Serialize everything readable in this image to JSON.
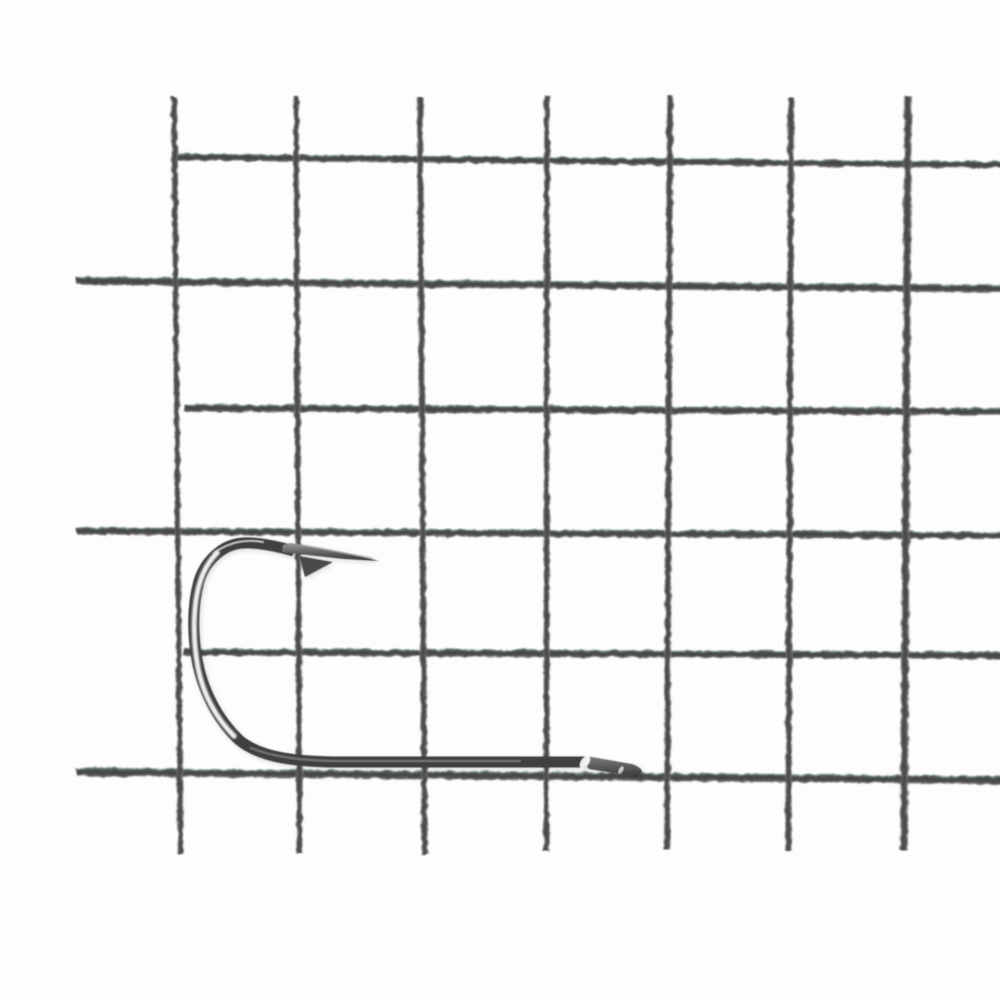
{
  "image": {
    "type": "photograph",
    "width_px": 1000,
    "height_px": 1000,
    "description": "Close-up product photograph of a single polished gunmetal fishing hook with a barbed spear point and a flattened spade end, lying point-up over a dark grey welded wire mesh grid on a white background. No text is visible.",
    "text_content": "none"
  },
  "palette": {
    "background": "#fdfdfd",
    "mesh_wire": "#454545",
    "mesh_fringe_teal": "#7aa29f",
    "hook_wire_dark": "#414141",
    "hook_mid_grey": "#6e6e6e",
    "hook_specular_highlight": "#f5f5f5"
  },
  "mesh": {
    "pattern": "welded square wire mesh",
    "rows_visible": 6,
    "columns_visible": 7,
    "approx_cell_size_px": 122,
    "horizontal_wires": [
      {
        "x": 177,
        "y": 157,
        "len": 828,
        "tilt": 0.55,
        "t": 7.5
      },
      {
        "x": 76,
        "y": 281,
        "len": 929,
        "tilt": 0.48,
        "t": 8.5
      },
      {
        "x": 184,
        "y": 408,
        "len": 821,
        "tilt": 0.26,
        "t": 8
      },
      {
        "x": 76,
        "y": 531,
        "len": 929,
        "tilt": 0.28,
        "t": 8
      },
      {
        "x": 184,
        "y": 652,
        "len": 821,
        "tilt": 0.24,
        "t": 8
      },
      {
        "x": 76,
        "y": 772,
        "len": 929,
        "tilt": 0.5,
        "t": 9
      }
    ],
    "vertical_wires": [
      {
        "x": 174,
        "y": 97,
        "len": 757,
        "tilt": -0.5,
        "t": 6.5
      },
      {
        "x": 296,
        "y": 96,
        "len": 757,
        "tilt": -0.28,
        "t": 6.5
      },
      {
        "x": 420,
        "y": 97,
        "len": 757,
        "tilt": -0.35,
        "t": 7
      },
      {
        "x": 547,
        "y": 96,
        "len": 755,
        "tilt": 0.05,
        "t": 6.5
      },
      {
        "x": 670,
        "y": 96,
        "len": 754,
        "tilt": 0.22,
        "t": 7
      },
      {
        "x": 791,
        "y": 97,
        "len": 753,
        "tilt": 0.2,
        "t": 7
      },
      {
        "x": 908,
        "y": 96,
        "len": 754,
        "tilt": 0.3,
        "t": 8.5
      }
    ]
  },
  "hook": {
    "style": "single barbed fishing hook, round bend, long shank, spade end",
    "orientation": "point and barb at upper left, shank horizontal, spade end at right",
    "bounds_px": {
      "left": 186,
      "top": 536,
      "right": 645,
      "bottom": 770
    },
    "parts": [
      {
        "name": "hook-wire",
        "d": "M294,551 C276,546 258,542 243,543 C224,544 206,559 199,581 C193,603 192,630 197,660 C203,692 218,720 239,740 C260,757 291,761 333,762 L586,762",
        "stroke": "#414141",
        "width": 11,
        "cap": "butt"
      },
      {
        "name": "hook-bend-highlight-soft",
        "d": "M217,553 C205,565 199,580 196,600 C193,622 194,646 198,668 C203,694 216,718 234,736",
        "stroke": "#ffffff",
        "width": 7,
        "opacity": 0.33,
        "cap": "round"
      },
      {
        "name": "hook-bend-highlight",
        "d": "M217,553 C205,565 199,580 196,600 C193,622 194,646 198,668 C203,694 216,718 234,736",
        "stroke": "#f2f2f2",
        "width": 3.8,
        "opacity": 0.95,
        "cap": "round"
      },
      {
        "name": "hook-apex-highlight",
        "d": "M263,542 C246,539 229,542 214,553",
        "stroke": "#e6e6e6",
        "width": 1.8,
        "opacity": 0.8,
        "cap": "round"
      },
      {
        "name": "hook-shank-sheen",
        "d": "M251,748 C273,757 299,760 333,761 L520,761",
        "stroke": "#8d8d8d",
        "width": 2.2,
        "opacity": 0.65,
        "cap": "round"
      },
      {
        "name": "hook-point",
        "d": "M379,561 Q330,548 290,543 L283,545 L282,552 Q315,556 345,559 Z",
        "fill": "url(#bladeGrad)"
      },
      {
        "name": "hook-point-edge-highlight",
        "d": "M372,558 L302,545",
        "stroke": "#b5b5b5",
        "width": 1.5,
        "opacity": 0.8,
        "cap": "round"
      },
      {
        "name": "hook-barb",
        "d": "M299,556 L333,562 L305,577 Z",
        "fill": "#4a4a4a"
      },
      {
        "name": "hook-spade-end",
        "d": "M586,756 L632,764 Q643,768 642,773 L637,777 L589,769 Q583,762 586,756 Z",
        "fill": "url(#spadeGrad)"
      },
      {
        "name": "spade-junction-highlight",
        "ellipse": {
          "cx": 585,
          "cy": 762,
          "rx": 7,
          "ry": 4,
          "rot": -55
        },
        "fill": "#ffffff",
        "opacity": 0.92
      },
      {
        "name": "spade-tip-highlight",
        "ellipse": {
          "cx": 621,
          "cy": 770,
          "rx": 4,
          "ry": 2,
          "rot": -60
        },
        "fill": "#ffffff",
        "opacity": 0.7
      }
    ]
  }
}
